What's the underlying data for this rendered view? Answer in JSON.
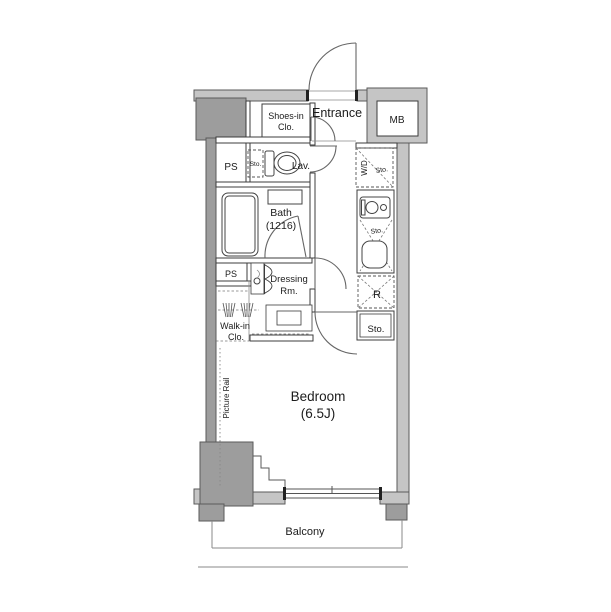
{
  "plan": {
    "type": "apartment-floor-plan",
    "labels": {
      "shoes_clo_1": "Shoes-in",
      "shoes_clo_2": "Clo.",
      "entrance": "Entrance",
      "mb": "MB",
      "ps_upper": "PS",
      "sto_lav": "Sto.",
      "lav": "Lav.",
      "wd": "W/D",
      "sto_wd": "Sto.",
      "bath_1": "Bath",
      "bath_2": "(1216)",
      "sto_kitchen": "Sto.",
      "ps_lower": "PS",
      "dressing_1": "Dressing",
      "dressing_2": "Rm.",
      "refrigerator": "R",
      "walkin_1": "Walk-in",
      "walkin_2": "Clo.",
      "sto_bedroom": "Sto.",
      "picture_rail": "Picture Rail",
      "bedroom_1": "Bedroom",
      "bedroom_2": "(6.5J)",
      "balcony": "Balcony"
    },
    "colors": {
      "wall_light": "#c5c5c5",
      "wall_dark": "#9d9d9d",
      "line": "#3c3c3c",
      "background": "#ffffff"
    }
  }
}
